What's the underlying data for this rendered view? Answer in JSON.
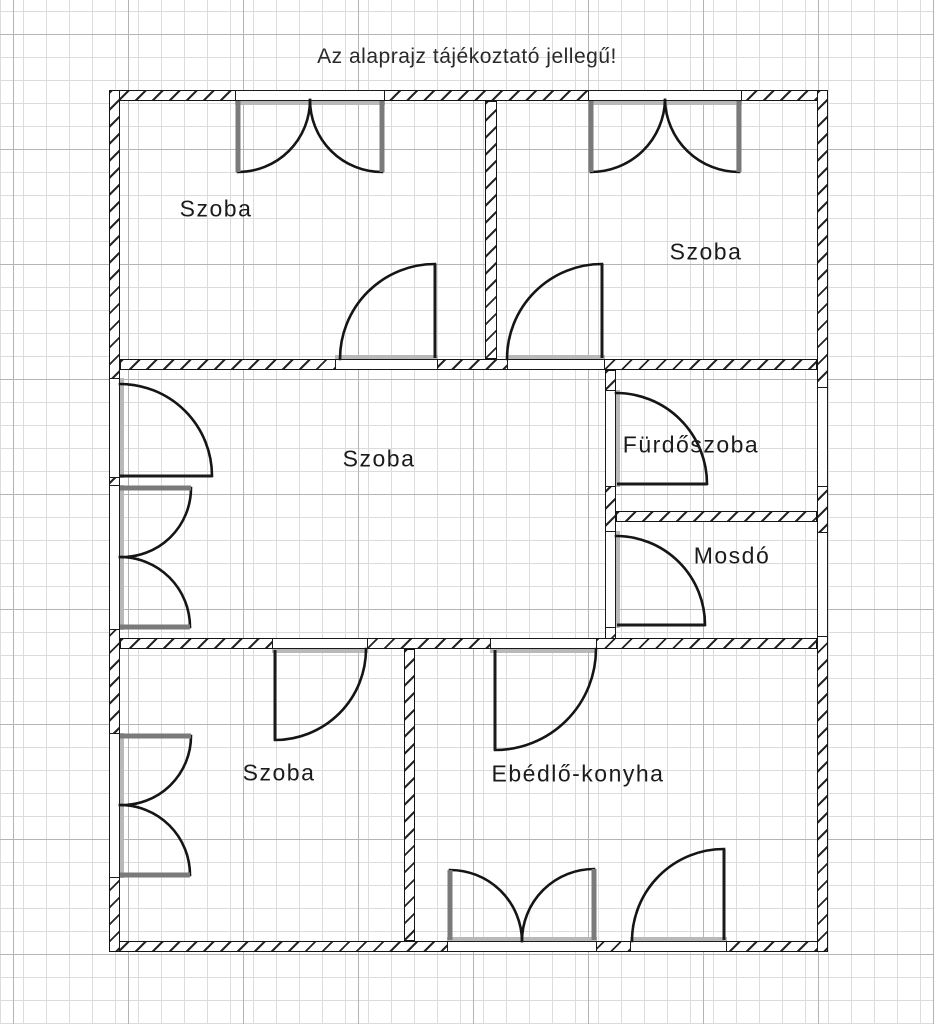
{
  "title": "Az alaprajz tájékoztató jellegű!",
  "plan": {
    "rooms": [
      {
        "id": "room-top-left",
        "label": "Szoba"
      },
      {
        "id": "room-top-right",
        "label": "Szoba"
      },
      {
        "id": "room-middle",
        "label": "Szoba"
      },
      {
        "id": "bathroom",
        "label": "Fürdőszoba"
      },
      {
        "id": "washroom",
        "label": "Mosdó"
      },
      {
        "id": "room-bottom-left",
        "label": "Szoba"
      },
      {
        "id": "dining-kitchen",
        "label": "Ebédlő-konyha"
      }
    ],
    "colors": {
      "background": "#ffffff",
      "wall_line": "#151515",
      "hatch": "#262626",
      "grid_minor": "#dcdcdc",
      "grid_major": "#b4b4b4",
      "label_text": "#1b1b1b",
      "window_leaf": "#7a7a7a",
      "threshold": "#b9b9b9"
    }
  }
}
